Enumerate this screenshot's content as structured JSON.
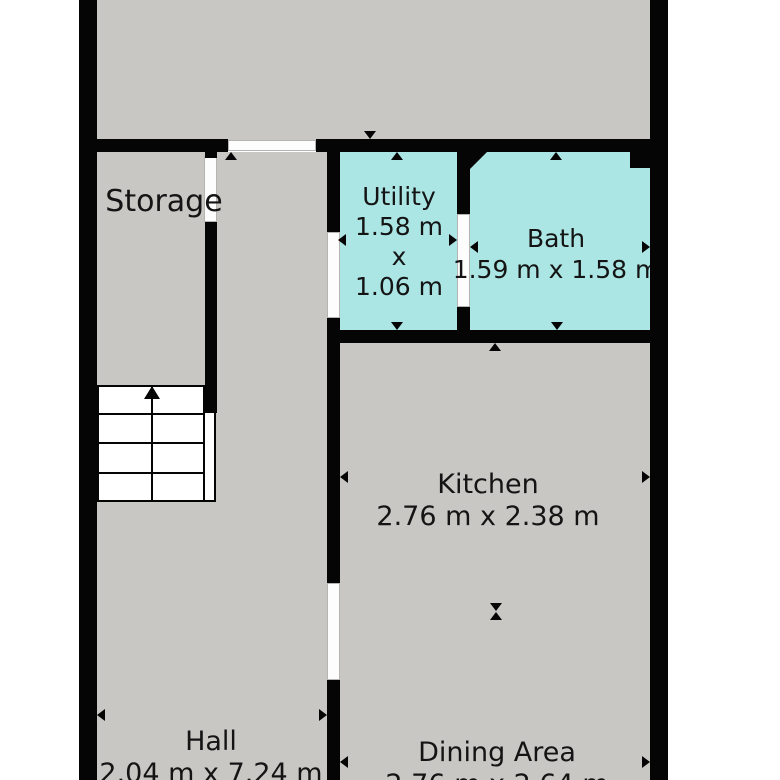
{
  "floorplan": {
    "colors": {
      "background": "#ffffff",
      "room_fill": "#c9c7c4",
      "wet_room_fill": "#abe5e4",
      "wall": "#050505",
      "door_fill": "#fdfdfd",
      "door_border": "#b6b4b1",
      "text": "#141414"
    },
    "rooms": {
      "storage": {
        "label": "Storage"
      },
      "utility": {
        "label": "Utility",
        "dim_width": "1.58 m",
        "dim_sep": "x",
        "dim_height": "1.06 m"
      },
      "bath": {
        "label": "Bath",
        "dims": "1.59 m x 1.58 m"
      },
      "kitchen": {
        "label": "Kitchen",
        "dims": "2.76 m x 2.38 m"
      },
      "hall": {
        "label": "Hall",
        "dims": "2.04 m x 7.24 m"
      },
      "dining": {
        "label": "Dining Area",
        "dims": "2.76 m x 2.64 m"
      }
    },
    "icons": {
      "stairs_direction": "up-arrow",
      "measure_marker": "triangle-arrow"
    }
  }
}
